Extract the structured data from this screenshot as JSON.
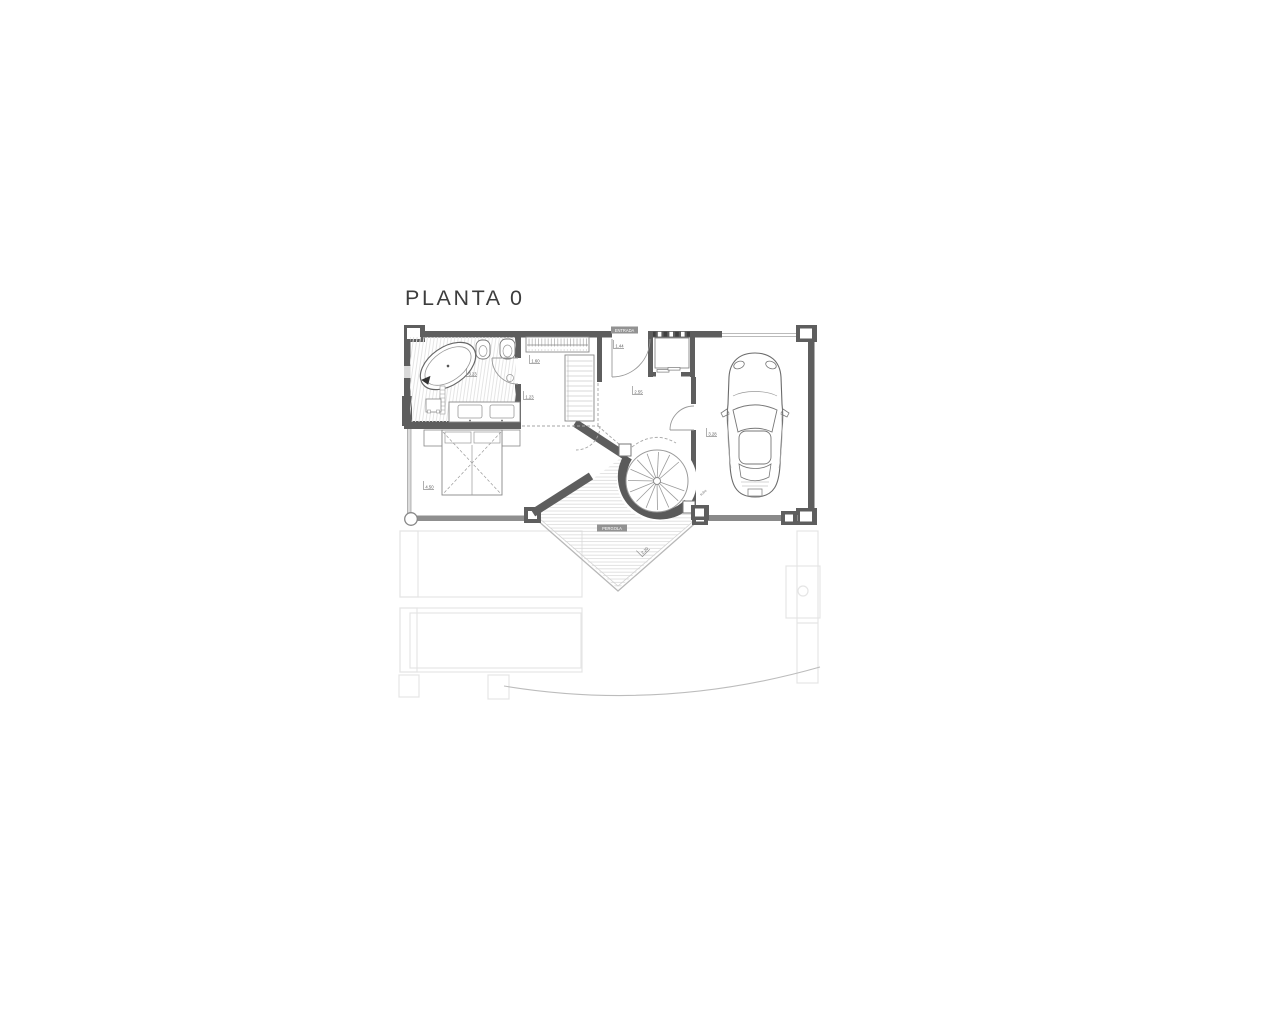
{
  "title": {
    "text": "PLANTA 0"
  },
  "chips": {
    "entry": "ENTRADA",
    "pergola": "PERGOLA"
  },
  "dimensions": {
    "bathroom": "3.23",
    "closet_width": "1.60",
    "closet_depth": "1.23",
    "entry": "1.44",
    "hallway": "2.55",
    "garage": "3.28",
    "bedroom": "4.50",
    "terrace": "2.20",
    "stair_note": "sube"
  },
  "colors": {
    "background": "#ffffff",
    "wall": "#5e5e5e",
    "wall_light": "#8f8f8f",
    "line": "#8a8a8a",
    "hatch": "#dcdcdc",
    "faint_outline": "#e5e5e5",
    "title_text": "#3d3d3d",
    "chip_bg": "#929292",
    "dim_text": "#5a5a5a"
  }
}
